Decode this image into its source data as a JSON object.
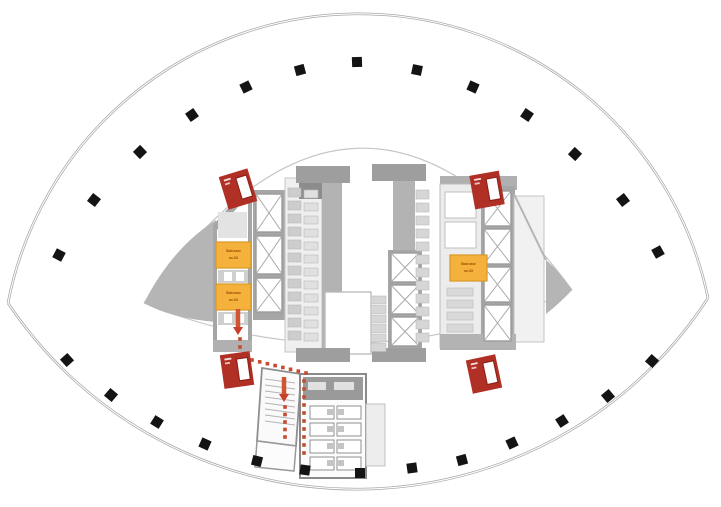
{
  "plan": {
    "description": "Lens / eye-shaped tower floor plan with central service core, fire-exit markers and evacuation route",
    "colors": {
      "shell": "#a8a8a8",
      "column": "#141414",
      "wall": "#a6a6a6",
      "wall_light": "#ececec",
      "wedge": "#b5b5b5",
      "orange_fill": "#f4b13c",
      "orange_stroke": "#d99a26",
      "orange_text": "#9c4a00",
      "marker_red": "#b03026",
      "route_red": "#c8492e"
    },
    "staircase_labels": [
      {
        "x": 216,
        "y": 242,
        "w": 35,
        "h": 26,
        "lines": [
          "Staircase",
          "no.XX"
        ]
      },
      {
        "x": 216,
        "y": 284,
        "w": 35,
        "h": 26,
        "lines": [
          "Staircase",
          "no.XX"
        ]
      },
      {
        "x": 450,
        "y": 255,
        "w": 37,
        "h": 26,
        "lines": [
          "Staircase",
          "no.XX"
        ]
      }
    ],
    "perimeter_columns": {
      "size": 10,
      "top": [
        [
          59,
          255,
          -62
        ],
        [
          94,
          200,
          -52
        ],
        [
          140,
          152,
          -44
        ],
        [
          192,
          115,
          -35
        ],
        [
          246,
          87,
          -26
        ],
        [
          300,
          70,
          -15
        ],
        [
          357,
          62,
          -2
        ],
        [
          417,
          70,
          12
        ],
        [
          473,
          87,
          24
        ],
        [
          527,
          115,
          34
        ],
        [
          575,
          154,
          43
        ],
        [
          623,
          200,
          52
        ],
        [
          658,
          252,
          61
        ]
      ],
      "bottom": [
        [
          67,
          360,
          48
        ],
        [
          111,
          395,
          40
        ],
        [
          157,
          422,
          32
        ],
        [
          205,
          444,
          24
        ],
        [
          257,
          461,
          14
        ],
        [
          305,
          470,
          8
        ],
        [
          360,
          473,
          0
        ],
        [
          412,
          468,
          -8
        ],
        [
          462,
          460,
          -15
        ],
        [
          512,
          443,
          -25
        ],
        [
          562,
          421,
          -33
        ],
        [
          608,
          396,
          -40
        ],
        [
          652,
          361,
          -48
        ]
      ]
    },
    "lift_banks": [
      {
        "x": 256,
        "w": 26,
        "cells": [
          [
            194,
            38
          ],
          [
            236,
            38
          ],
          [
            278,
            34
          ]
        ]
      },
      {
        "x": 391,
        "w": 28,
        "cells": [
          [
            253,
            29
          ],
          [
            285,
            29
          ],
          [
            317,
            29
          ]
        ]
      },
      {
        "x": 484,
        "w": 27,
        "cells": [
          [
            191,
            35
          ],
          [
            229,
            35
          ],
          [
            267,
            35
          ],
          [
            305,
            36
          ]
        ]
      }
    ],
    "fixture_strips": [
      {
        "x": 288,
        "y": 188,
        "w": 13,
        "h": 9,
        "n": 12,
        "dy": 13,
        "color": "#cdcdcd"
      },
      {
        "x": 304,
        "y": 190,
        "w": 14,
        "h": 8,
        "n": 12,
        "dy": 13,
        "color": "#e0e0e0"
      },
      {
        "x": 371,
        "y": 296,
        "w": 15,
        "h": 8,
        "n": 6,
        "dy": 9.5,
        "color": "#d6d6d6"
      },
      {
        "x": 416,
        "y": 190,
        "w": 13,
        "h": 9,
        "n": 12,
        "dy": 13,
        "color": "#d6d6d6"
      },
      {
        "x": 447,
        "y": 288,
        "w": 26,
        "h": 8,
        "n": 4,
        "dy": 12,
        "color": "#d9d9d9"
      },
      {
        "x": 369,
        "y": 408,
        "w": 13,
        "h": 13,
        "n": 3,
        "dy": 20,
        "color": "#e2e2e2"
      }
    ],
    "exit_markers": [
      {
        "cx": 238,
        "cy": 189,
        "rot": -17
      },
      {
        "cx": 487,
        "cy": 190,
        "rot": -10
      },
      {
        "cx": 237,
        "cy": 370,
        "rot": -8
      },
      {
        "cx": 484,
        "cy": 374,
        "rot": -12
      }
    ],
    "route": {
      "arrows": [
        {
          "x": 238,
          "y1": 309,
          "y2": 334
        },
        {
          "x": 284,
          "y1": 377,
          "y2": 401
        }
      ],
      "dash_segments": [
        {
          "x1": 240,
          "y1": 339,
          "x2": 240,
          "y2": 355,
          "n": 3
        },
        {
          "x1": 252,
          "y1": 360,
          "x2": 306,
          "y2": 373,
          "n": 8
        },
        {
          "x1": 304,
          "y1": 381,
          "x2": 304,
          "y2": 453,
          "n": 10
        },
        {
          "x1": 285,
          "y1": 407,
          "x2": 285,
          "y2": 437,
          "n": 5
        }
      ]
    },
    "desks": {
      "x": 310,
      "y": 406,
      "cols": 2,
      "col_dx": 27,
      "rows": 4,
      "row_dy": 17,
      "w": 24,
      "h": 13
    }
  }
}
